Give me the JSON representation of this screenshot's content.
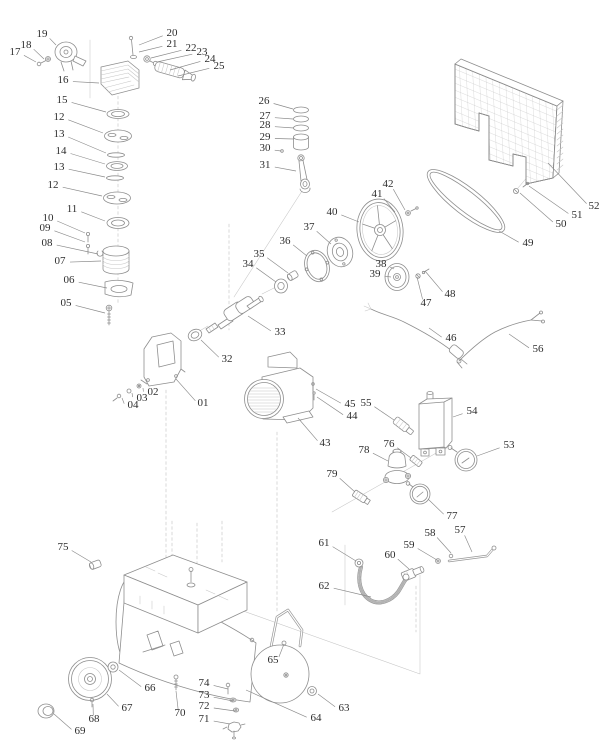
{
  "meta": {
    "description": "Air compressor exploded parts diagram",
    "background_color": "#ffffff",
    "line_color": "#8e8e8e",
    "label_color": "#2d2d2d"
  },
  "diagram": {
    "callouts": [
      {
        "t": "01",
        "x": 203,
        "y": 402,
        "tx": 176,
        "ty": 379
      },
      {
        "t": "02",
        "x": 153,
        "y": 391,
        "tx": 143,
        "ty": 388
      },
      {
        "t": "03",
        "x": 142,
        "y": 397,
        "tx": 132,
        "ty": 393
      },
      {
        "t": "04",
        "x": 133,
        "y": 404,
        "tx": 122,
        "ty": 398
      },
      {
        "t": "05",
        "x": 66,
        "y": 302,
        "tx": 105,
        "ty": 313
      },
      {
        "t": "06",
        "x": 69,
        "y": 279,
        "tx": 107,
        "ty": 288
      },
      {
        "t": "07",
        "x": 60,
        "y": 260,
        "tx": 101,
        "ty": 261
      },
      {
        "t": "08",
        "x": 47,
        "y": 242,
        "tx": 98,
        "ty": 254
      },
      {
        "t": "09",
        "x": 45,
        "y": 227,
        "tx": 85,
        "ty": 242
      },
      {
        "t": "10",
        "x": 48,
        "y": 217,
        "tx": 85,
        "ty": 233
      },
      {
        "t": "11",
        "x": 72,
        "y": 208,
        "tx": 105,
        "ty": 221
      },
      {
        "t": "12",
        "x": 59,
        "y": 116,
        "tx": 103,
        "ty": 133
      },
      {
        "t": "13",
        "x": 59,
        "y": 133,
        "tx": 106,
        "ty": 153
      },
      {
        "t": "14",
        "x": 61,
        "y": 150,
        "tx": 105,
        "ty": 164
      },
      {
        "t": "13",
        "x": 59,
        "y": 166,
        "tx": 105,
        "ty": 177
      },
      {
        "t": "12",
        "x": 53,
        "y": 184,
        "tx": 102,
        "ty": 196
      },
      {
        "t": "15",
        "x": 62,
        "y": 99,
        "tx": 106,
        "ty": 112
      },
      {
        "t": "16",
        "x": 63,
        "y": 79,
        "tx": 99,
        "ty": 83
      },
      {
        "t": "17",
        "x": 15,
        "y": 51,
        "tx": 36,
        "ty": 62
      },
      {
        "t": "18",
        "x": 26,
        "y": 44,
        "tx": 44,
        "ty": 59
      },
      {
        "t": "19",
        "x": 42,
        "y": 33,
        "tx": 56,
        "ty": 45
      },
      {
        "t": "20",
        "x": 172,
        "y": 32,
        "tx": 139,
        "ty": 45
      },
      {
        "t": "21",
        "x": 172,
        "y": 43,
        "tx": 139,
        "ty": 52
      },
      {
        "t": "22",
        "x": 191,
        "y": 47,
        "tx": 151,
        "ty": 58
      },
      {
        "t": "23",
        "x": 202,
        "y": 51,
        "tx": 157,
        "ty": 62
      },
      {
        "t": "24",
        "x": 210,
        "y": 58,
        "tx": 170,
        "ty": 70
      },
      {
        "t": "25",
        "x": 219,
        "y": 65,
        "tx": 178,
        "ty": 76
      },
      {
        "t": "26",
        "x": 264,
        "y": 100,
        "tx": 293,
        "ty": 109
      },
      {
        "t": "27",
        "x": 265,
        "y": 115,
        "tx": 293,
        "ty": 119
      },
      {
        "t": "28",
        "x": 265,
        "y": 124,
        "tx": 294,
        "ty": 128
      },
      {
        "t": "29",
        "x": 265,
        "y": 136,
        "tx": 294,
        "ty": 139
      },
      {
        "t": "30",
        "x": 265,
        "y": 147,
        "tx": 281,
        "ty": 151
      },
      {
        "t": "31",
        "x": 265,
        "y": 164,
        "tx": 296,
        "ty": 171
      },
      {
        "t": "32",
        "x": 227,
        "y": 358,
        "tx": 201,
        "ty": 340
      },
      {
        "t": "33",
        "x": 280,
        "y": 331,
        "tx": 248,
        "ty": 316
      },
      {
        "t": "34",
        "x": 248,
        "y": 263,
        "tx": 276,
        "ty": 282
      },
      {
        "t": "35",
        "x": 259,
        "y": 253,
        "tx": 288,
        "ty": 273
      },
      {
        "t": "36",
        "x": 285,
        "y": 240,
        "tx": 307,
        "ty": 256
      },
      {
        "t": "37",
        "x": 309,
        "y": 226,
        "tx": 331,
        "ty": 244
      },
      {
        "t": "38",
        "x": 381,
        "y": 263,
        "tx": 394,
        "ty": 269
      },
      {
        "t": "39",
        "x": 375,
        "y": 273,
        "tx": 391,
        "ty": 277
      },
      {
        "t": "40",
        "x": 332,
        "y": 211,
        "tx": 359,
        "ty": 222
      },
      {
        "t": "41",
        "x": 377,
        "y": 193,
        "tx": 395,
        "ty": 212
      },
      {
        "t": "42",
        "x": 388,
        "y": 183,
        "tx": 405,
        "ty": 210
      },
      {
        "t": "43",
        "x": 325,
        "y": 442,
        "tx": 298,
        "ty": 418
      },
      {
        "t": "44",
        "x": 352,
        "y": 415,
        "tx": 317,
        "ty": 397
      },
      {
        "t": "45",
        "x": 350,
        "y": 403,
        "tx": 316,
        "ty": 389
      },
      {
        "t": "46",
        "x": 451,
        "y": 337,
        "tx": 429,
        "ty": 328
      },
      {
        "t": "47",
        "x": 426,
        "y": 302,
        "tx": 417,
        "ty": 277
      },
      {
        "t": "48",
        "x": 450,
        "y": 293,
        "tx": 425,
        "ty": 271
      },
      {
        "t": "49",
        "x": 528,
        "y": 242,
        "tx": 499,
        "ty": 231
      },
      {
        "t": "50",
        "x": 561,
        "y": 223,
        "tx": 520,
        "ty": 193
      },
      {
        "t": "51",
        "x": 577,
        "y": 214,
        "tx": 529,
        "ty": 186
      },
      {
        "t": "52",
        "x": 594,
        "y": 205,
        "tx": 548,
        "ty": 163
      },
      {
        "t": "53",
        "x": 509,
        "y": 444,
        "tx": 477,
        "ty": 456
      },
      {
        "t": "54",
        "x": 472,
        "y": 410,
        "tx": 453,
        "ty": 417
      },
      {
        "t": "55",
        "x": 366,
        "y": 402,
        "tx": 394,
        "ty": 420
      },
      {
        "t": "56",
        "x": 538,
        "y": 348,
        "tx": 509,
        "ty": 334
      },
      {
        "t": "57",
        "x": 460,
        "y": 529,
        "tx": 472,
        "ty": 552
      },
      {
        "t": "58",
        "x": 430,
        "y": 532,
        "tx": 451,
        "ty": 553
      },
      {
        "t": "59",
        "x": 409,
        "y": 544,
        "tx": 437,
        "ty": 560
      },
      {
        "t": "60",
        "x": 390,
        "y": 554,
        "tx": 409,
        "ty": 569
      },
      {
        "t": "61",
        "x": 324,
        "y": 542,
        "tx": 356,
        "ty": 561
      },
      {
        "t": "62",
        "x": 324,
        "y": 585,
        "tx": 371,
        "ty": 597
      },
      {
        "t": "63",
        "x": 344,
        "y": 707,
        "tx": 318,
        "ty": 694
      },
      {
        "t": "64",
        "x": 316,
        "y": 717,
        "tx": 246,
        "ty": 690
      },
      {
        "t": "65",
        "x": 273,
        "y": 659,
        "tx": 284,
        "ty": 644
      },
      {
        "t": "66",
        "x": 150,
        "y": 687,
        "tx": 119,
        "ty": 670
      },
      {
        "t": "67",
        "x": 127,
        "y": 707,
        "tx": 107,
        "ty": 694
      },
      {
        "t": "68",
        "x": 94,
        "y": 718,
        "tx": 93,
        "ty": 704
      },
      {
        "t": "69",
        "x": 80,
        "y": 730,
        "tx": 54,
        "ty": 714
      },
      {
        "t": "70",
        "x": 180,
        "y": 712,
        "tx": 176,
        "ty": 691
      },
      {
        "t": "71",
        "x": 204,
        "y": 718,
        "tx": 230,
        "ty": 724
      },
      {
        "t": "72",
        "x": 204,
        "y": 705,
        "tx": 235,
        "ty": 711
      },
      {
        "t": "73",
        "x": 204,
        "y": 694,
        "tx": 233,
        "ty": 701
      },
      {
        "t": "74",
        "x": 204,
        "y": 682,
        "tx": 228,
        "ty": 689
      },
      {
        "t": "75",
        "x": 63,
        "y": 546,
        "tx": 91,
        "ty": 562
      },
      {
        "t": "76",
        "x": 389,
        "y": 443,
        "tx": 411,
        "ty": 458
      },
      {
        "t": "77",
        "x": 452,
        "y": 515,
        "tx": 428,
        "ty": 499
      },
      {
        "t": "78",
        "x": 364,
        "y": 449,
        "tx": 388,
        "ty": 461
      },
      {
        "t": "79",
        "x": 332,
        "y": 473,
        "tx": 355,
        "ty": 492
      }
    ]
  }
}
